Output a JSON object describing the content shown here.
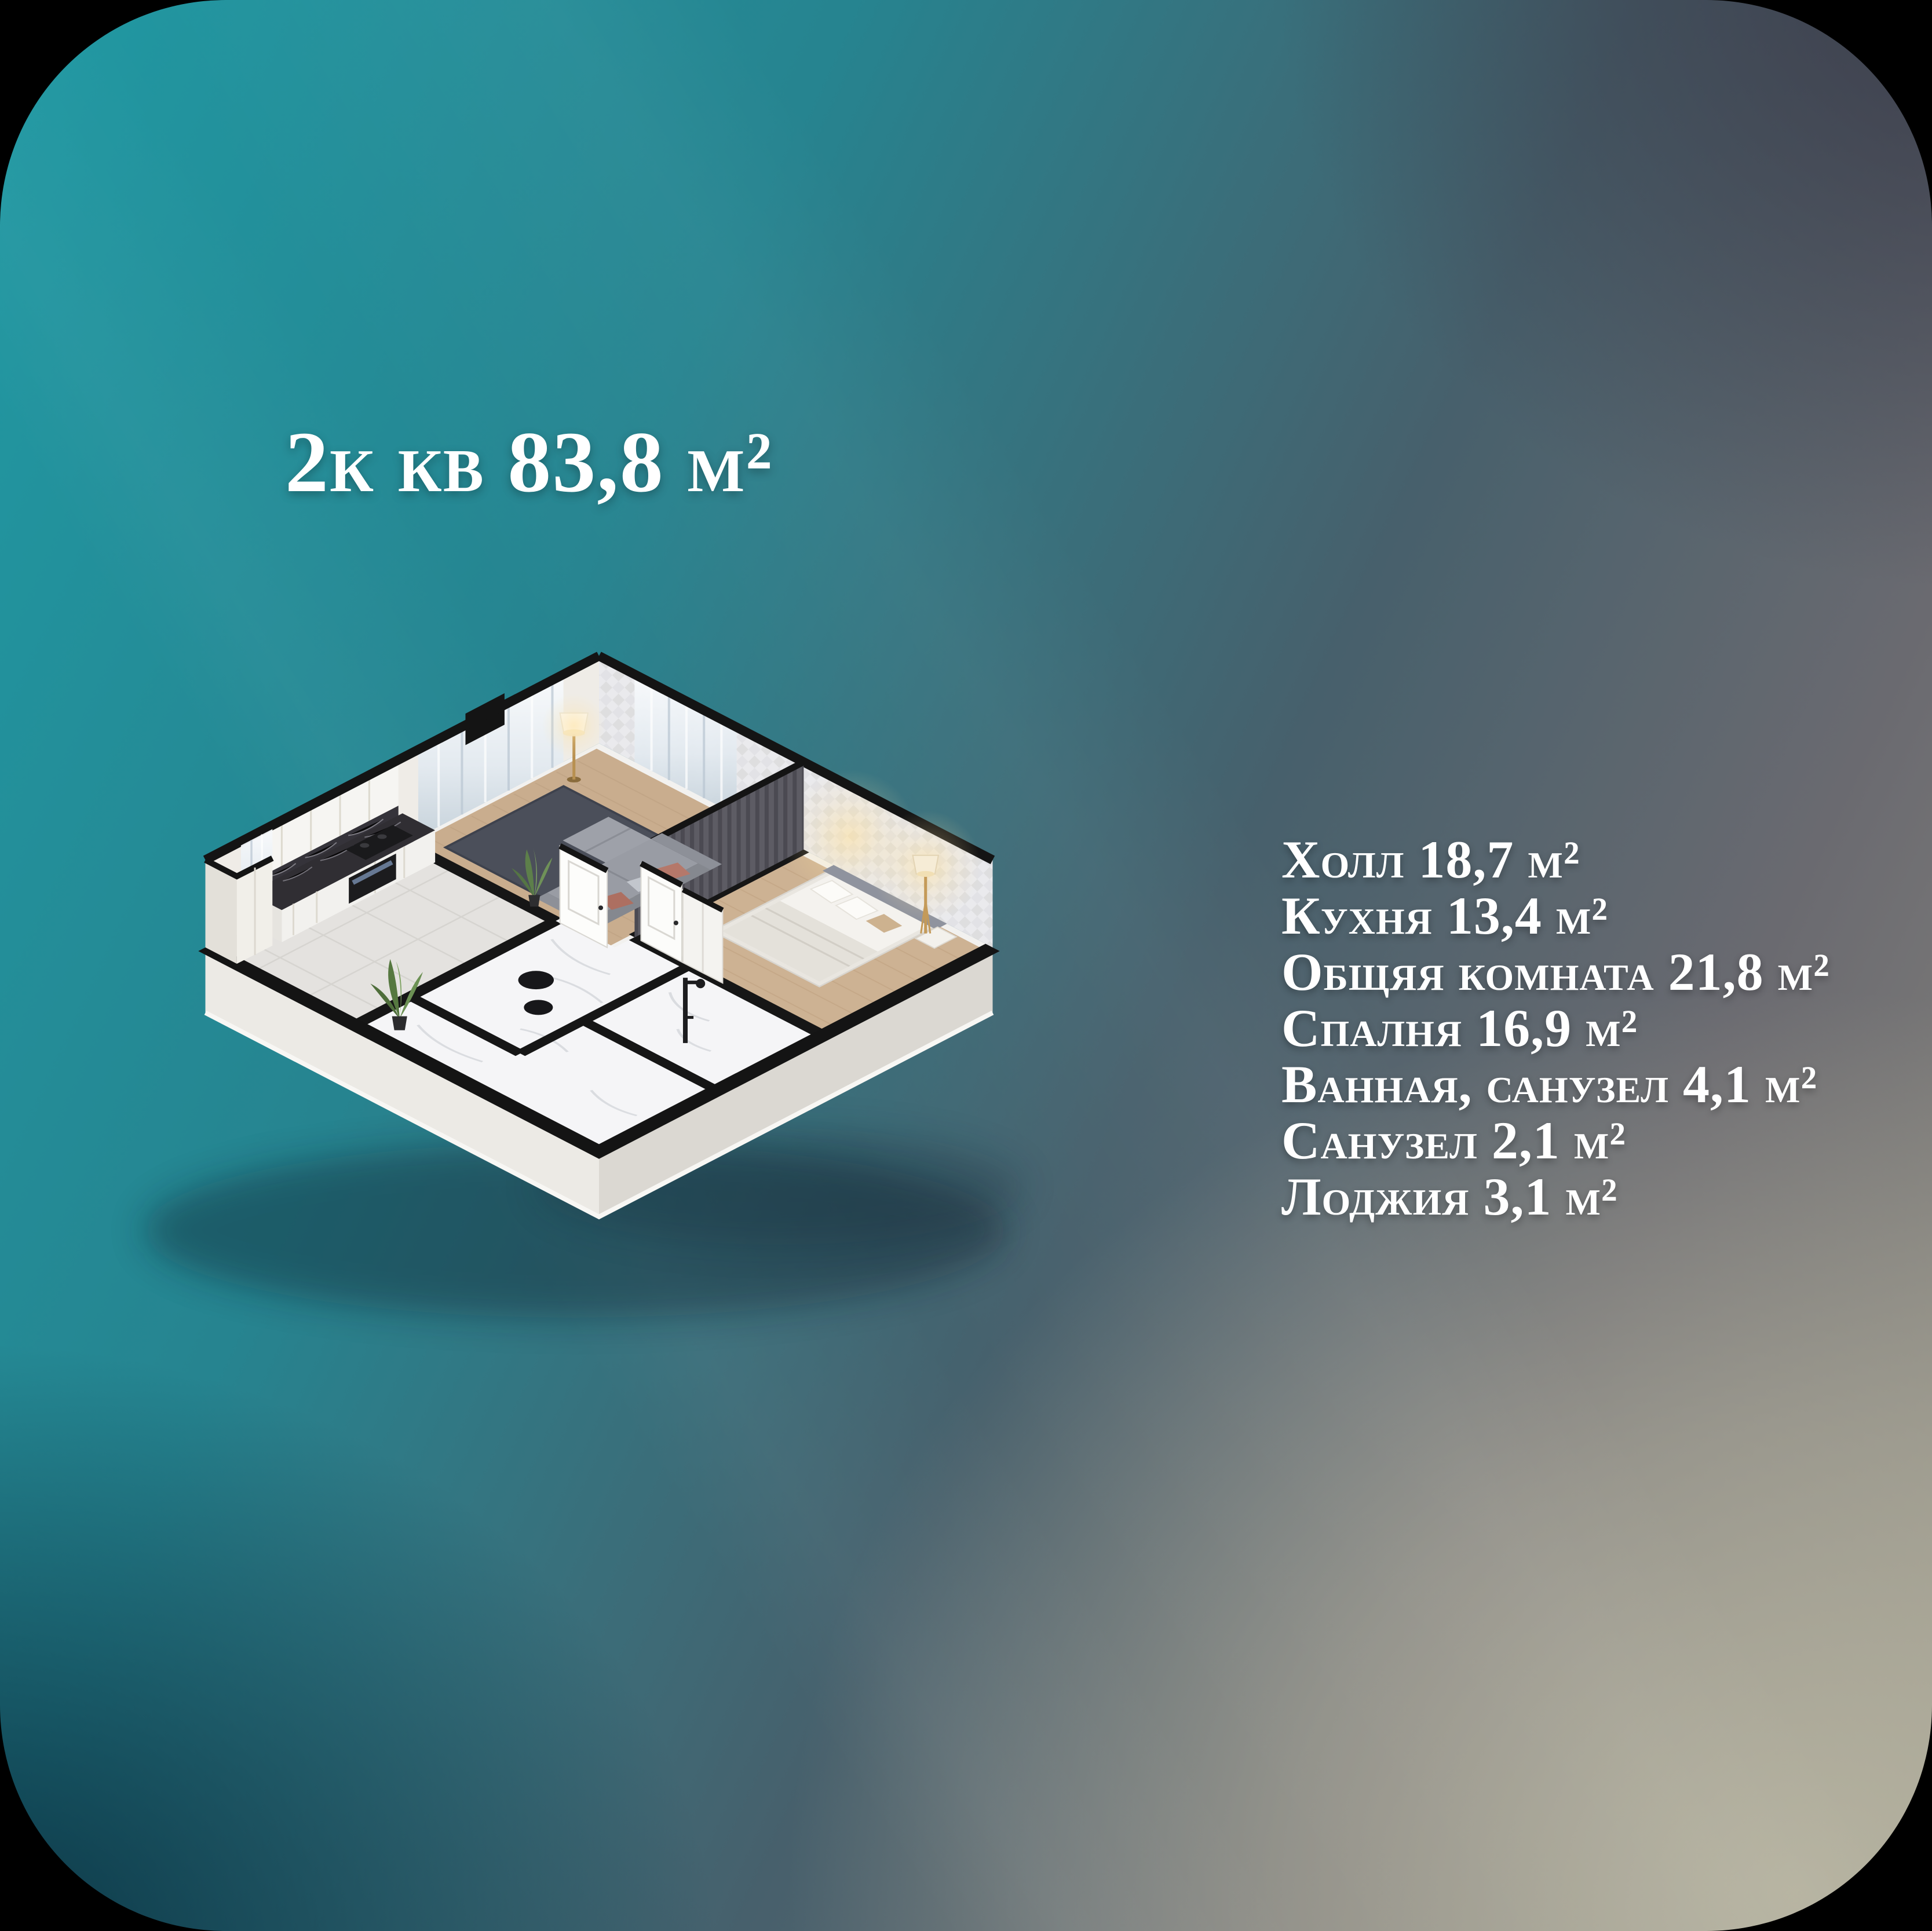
{
  "page": {
    "frame_color": "#000000",
    "corner_radius_px": 390
  },
  "card": {
    "title": "2к кв 83,8 м²",
    "text_color": "#ffffff",
    "gradient": {
      "teal_top_left": "#2099a3",
      "slate_top_right": "#383846",
      "navy_bottom_left": "#0a3040",
      "beige_bottom_right": "#b8b5a2"
    }
  },
  "room_list": {
    "items": [
      {
        "label": "Холл 18,7 м²"
      },
      {
        "label": "Кухня 13,4 м²"
      },
      {
        "label": "Общяя комната 21,8 м²"
      },
      {
        "label": "Спалня 16,9 м²"
      },
      {
        "label": "Ванная, санузел 4,1 м²"
      },
      {
        "label": "Санузел 2,1 м²"
      },
      {
        "label": "Лоджия 3,1 м²"
      }
    ]
  },
  "floor_plan": {
    "kind": "isometric 3D cutaway render of a 2-room apartment",
    "palette": {
      "wall_cut_top": "#141414",
      "wall_face": "#efece7",
      "outer_base": "#eceae5",
      "wood_floor": "#c9ad8e",
      "marble_floor": "#f5f5f7",
      "rug": "#4b4f5a",
      "sofa": "#999ca4",
      "accent_wall": "#5d5c64",
      "counter_marble": "#302e33",
      "curtain": "#dfe7ee",
      "plant": "#5f7f4b",
      "lamp_glow": "#ffe2a0"
    }
  }
}
